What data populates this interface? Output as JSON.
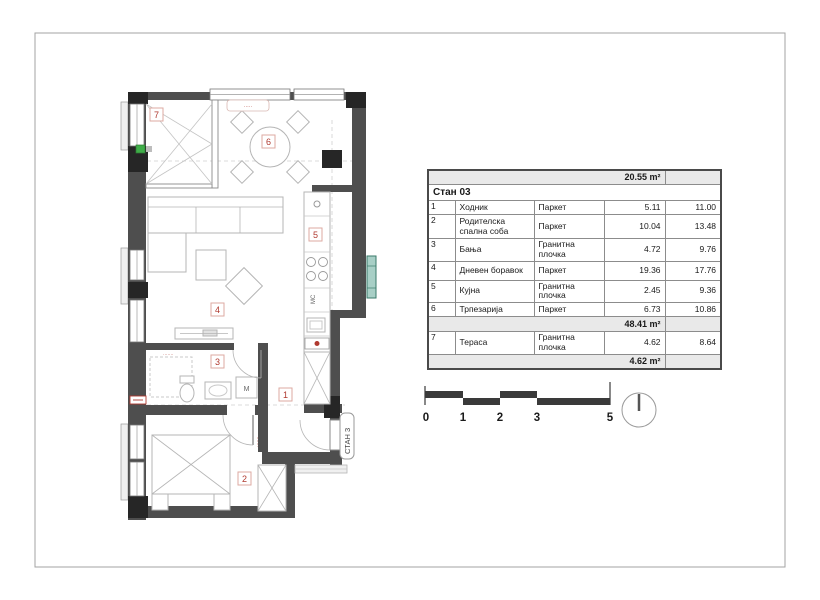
{
  "plan": {
    "room_numbers": [
      "1",
      "2",
      "3",
      "4",
      "5",
      "6",
      "7"
    ],
    "entrance_label": "СТАН 3",
    "kitchen_label": "МС",
    "washer_label": "М",
    "annotations": {
      "window_tag": "·····",
      "bathroom_tag": "·······",
      "bedroom_door_tag": "·······"
    },
    "colors": {
      "wall": "#4e4e4e",
      "column": "#262626",
      "furniture": "#b5b5b5",
      "accent_red": "#b03a30",
      "duct_teal": "#a8cfc6",
      "green_marker": "#3fae49"
    }
  },
  "table": {
    "pre_total": "20.55 m²",
    "title": "Стан 03",
    "rows": [
      {
        "no": "1",
        "name": "Ходник",
        "floor": "Паркет",
        "area": "5.11",
        "perimeter": "11.00"
      },
      {
        "no": "2",
        "name": "Родителска спална соба",
        "floor": "Паркет",
        "area": "10.04",
        "perimeter": "13.48"
      },
      {
        "no": "3",
        "name": "Бања",
        "floor": "Гранитна плочка",
        "area": "4.72",
        "perimeter": "9.76"
      },
      {
        "no": "4",
        "name": "Дневен боравок",
        "floor": "Паркет",
        "area": "19.36",
        "perimeter": "17.76"
      },
      {
        "no": "5",
        "name": "Кујна",
        "floor": "Гранитна плочка",
        "area": "2.45",
        "perimeter": "9.36"
      },
      {
        "no": "6",
        "name": "Трпезарија",
        "floor": "Паркет",
        "area": "6.73",
        "perimeter": "10.86"
      },
      {
        "no": "7",
        "name": "Тераса",
        "floor": "Гранитна плочка",
        "area": "4.62",
        "perimeter": "8.64"
      }
    ],
    "subtotal": "48.41 m²",
    "total": "4.62 m²"
  },
  "scalebar": {
    "ticks": [
      "0",
      "1",
      "2",
      "3",
      "5"
    ]
  }
}
